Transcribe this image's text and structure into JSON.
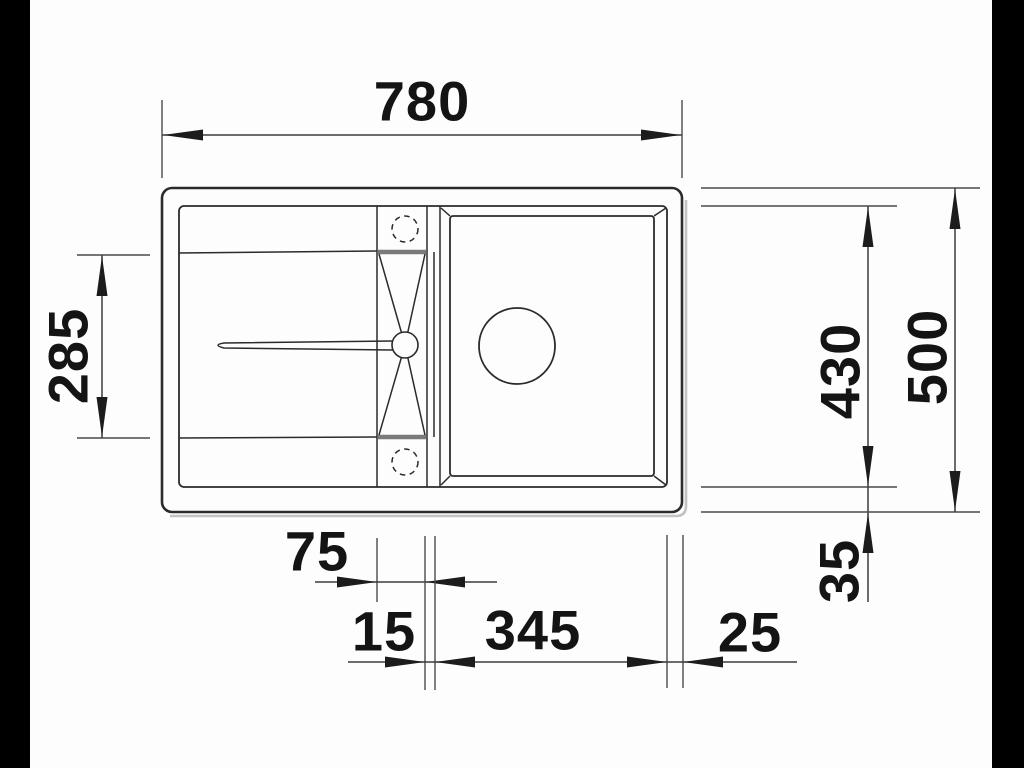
{
  "diagram": {
    "type": "sink-installation-drawing",
    "dimensions": {
      "overall_width": "780",
      "overall_depth": "500",
      "drainboard_depth": "285",
      "inner_depth": "430",
      "bottom_margin": "35",
      "tap_ledge_width": "75",
      "rim_gap": "15",
      "bowl_width": "345",
      "right_margin": "25"
    },
    "colors": {
      "object_line": "#2b2b2b",
      "dimension_line": "#3c3c3c",
      "shadow": "#c2c2c2",
      "background": "#fdfdfd",
      "pillarbox": "#000000"
    }
  }
}
